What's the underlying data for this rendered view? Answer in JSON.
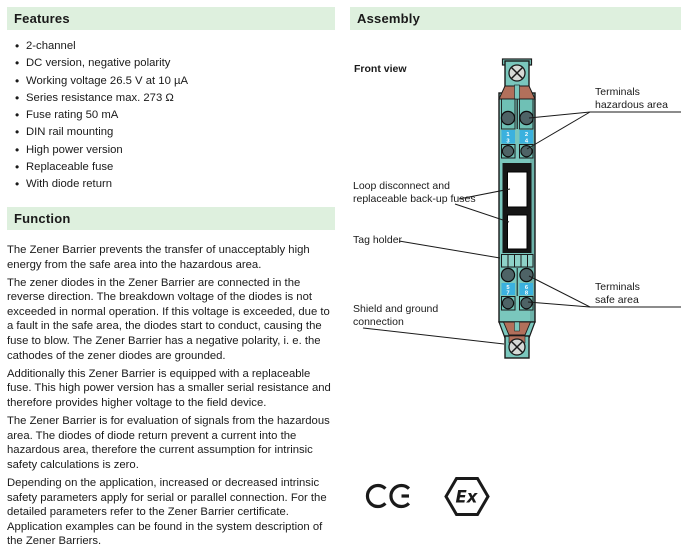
{
  "features": {
    "title": "Features",
    "items": [
      "2-channel",
      "DC version, negative polarity",
      "Working voltage 26.5 V at 10 µA",
      "Series resistance max. 273 Ω",
      "Fuse rating 50 mA",
      "DIN rail mounting",
      "High power version",
      "Replaceable fuse",
      "With diode return"
    ]
  },
  "function": {
    "title": "Function",
    "paragraphs": [
      "The Zener Barrier prevents the transfer of unacceptably high energy from the safe area into the hazardous area.",
      "The zener diodes in the Zener Barrier are connected in the reverse direction. The breakdown voltage of the diodes is not exceeded in normal operation. If this voltage is exceeded, due to a fault in the safe area, the diodes start to conduct, causing the fuse to blow. The Zener Barrier has a negative polarity, i. e. the cathodes of the zener diodes are grounded.",
      "Additionally this Zener Barrier is equipped with a replaceable fuse. This high power version has a smaller serial resistance and therefore provides higher voltage to the field device.",
      "The Zener Barrier is for evaluation of signals from the hazardous area. The diodes of diode return prevent a current into the hazardous area, therefore the current assumption for intrinsic safety calculations is zero.",
      "Depending on the application, increased or decreased intrinsic safety parameters apply for serial or parallel connection. For the detailed parameters refer to the Zener Barrier certificate. Application examples can be found in the system description of the Zener Barriers."
    ]
  },
  "assembly": {
    "title": "Assembly",
    "front_view_label": "Front view",
    "callouts": {
      "terminals_hazardous": [
        "Terminals",
        "hazardous area"
      ],
      "loop_fuses": [
        "Loop disconnect and",
        "replaceable back-up fuses"
      ],
      "tag_holder": [
        "Tag holder"
      ],
      "terminals_safe": [
        "Terminals",
        "safe area"
      ],
      "shield_ground": [
        "Shield and ground",
        "connection"
      ]
    },
    "terminals": {
      "hazardous": [
        "1",
        "2",
        "3",
        "4"
      ],
      "safe": [
        "5",
        "6",
        "7",
        "8"
      ]
    },
    "marks": {
      "ce_mark": "CE",
      "ex_label": "Ex"
    }
  },
  "colors": {
    "section_header_bg": "#def0de",
    "device_teal": "#7ac7bd",
    "device_teal_dark": "#65b7ac",
    "terminal_screw_dark": "#4e6366",
    "terminal_tag_blue": "#3bb1de",
    "copper_brown": "#b2705b",
    "fuse_block_black": "#161616",
    "outline": "#1a1a1a"
  }
}
